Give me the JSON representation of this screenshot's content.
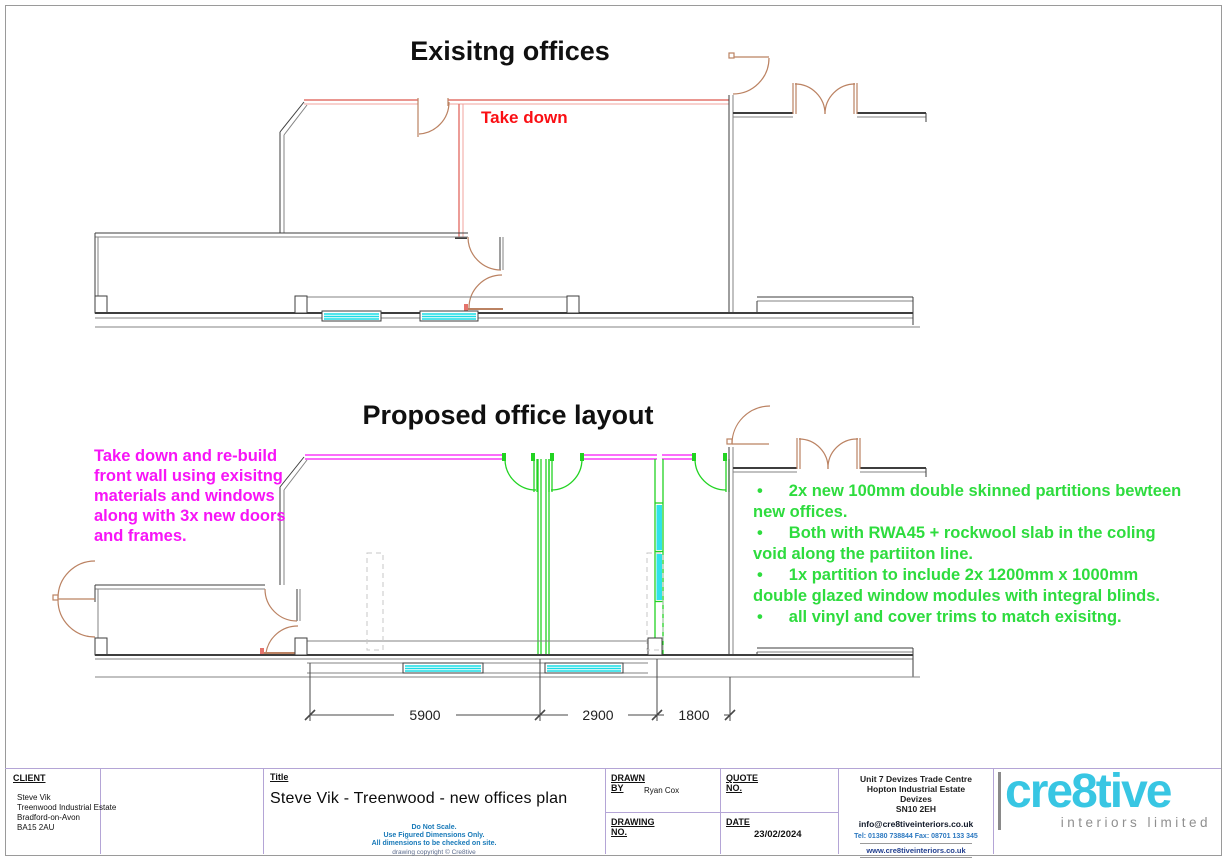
{
  "existing_plan": {
    "title": "Exisitng offices",
    "annotation": "Take down"
  },
  "proposed_plan": {
    "title": "Proposed office layout",
    "note_magenta": "Take down and re-build front wall using exisitng materials and windows along with 3x new doors and frames.",
    "bullet_char": "•",
    "bullets": [
      "2x new 100mm double skinned partitions bewteen new offices.",
      "Both with RWA45 + rockwool slab in the coling void along the partiiton line.",
      "1x partition to include 2x 1200mm x 1000mm double glazed window modules with integral blinds.",
      "all vinyl and cover trims to match exisitng."
    ],
    "dimensions": [
      "5900",
      "2900",
      "1800"
    ]
  },
  "title_block": {
    "client_label": "CLIENT",
    "client_lines": [
      "Steve Vik",
      "Treenwood Industrial Estate",
      "Bradford-on-Avon",
      "BA15 2AU"
    ],
    "title_label": "Title",
    "drawing_title": "Steve Vik - Treenwood -  new offices plan",
    "notes": [
      "Do Not Scale.",
      "Use Figured Dimensions Only.",
      "All dimensions to be checked on site."
    ],
    "copyright": "drawing copyright © Cre8tive",
    "drawn_by_label": "DRAWN BY",
    "drawn_by": "Ryan Cox",
    "drawing_no_label": "DRAWING NO.",
    "quote_no_label": "QUOTE NO.",
    "date_label": "DATE",
    "date": "23/02/2024",
    "company": {
      "address": [
        "Unit 7 Devizes Trade Centre",
        "Hopton Industrial Estate",
        "Devizes",
        "SN10 2EH"
      ],
      "email": "info@cre8tiveinteriors.co.uk",
      "tel": "Tel: 01380 738844  Fax:  08701 133 345",
      "web": "www.cre8tiveinteriors.co.uk",
      "logo_text": "cre8tive",
      "logo_sub": "interiors limited"
    }
  },
  "colors": {
    "wall_dark": "#3e3e3e",
    "wall_red": "#e4736b",
    "door_brown": "#bb8262",
    "window_cyan": "#19dde6",
    "partition_green": "#22d322",
    "wall_magenta": "#f714f7",
    "text_red": "#fa0f14",
    "text_green": "#2edc3e",
    "text_magenta": "#f714f7",
    "titleblock_line": "#b4a5d6",
    "logo_cyan": "#38c6e3",
    "note_blue": "#1879b8"
  }
}
